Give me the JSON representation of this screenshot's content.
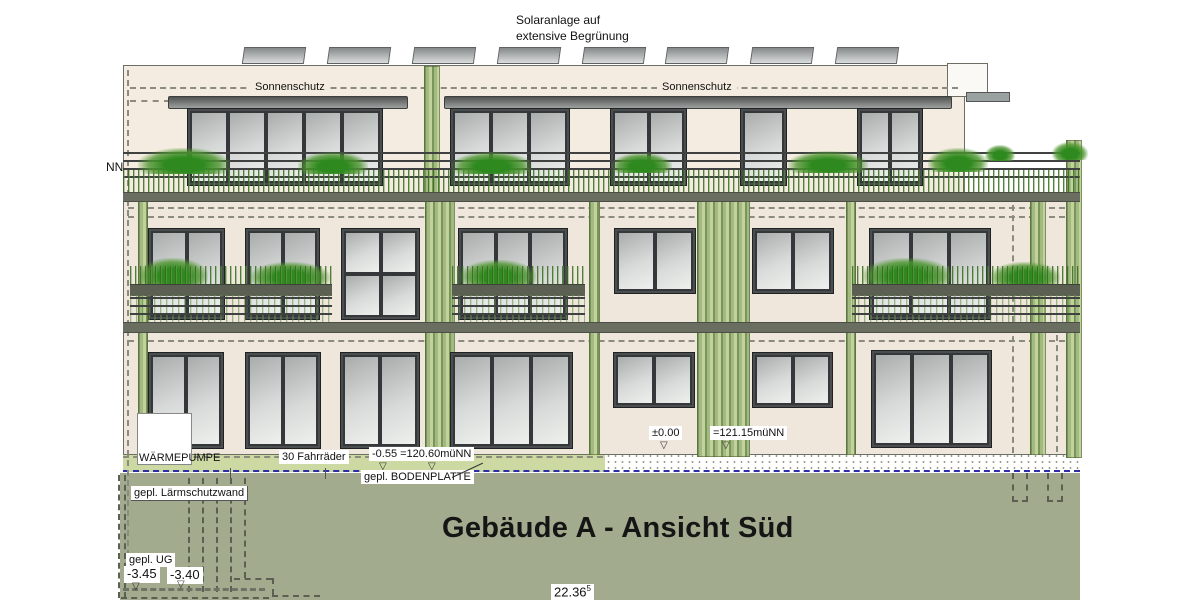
{
  "drawing": {
    "title": "Gebäude A - Ansicht Süd",
    "roof_note_line1": "Solaranlage auf",
    "roof_note_line2": "extensive Begrünung",
    "sonnenschutz_left": "Sonnenschutz",
    "sonnenschutz_right": "Sonnenschutz",
    "left_level_partial": "NN",
    "heat_pump": "WÄRMEPUMPE",
    "bikes": "30 Fahrräder",
    "level_ground_floor": "-0.55 =120.60müNN",
    "base_plate": "gepl. BODENPLATTE",
    "level_zero": "±0.00",
    "level_zero_value": "=121.15müNN",
    "noise_wall": "gepl. Lärmschutzwand",
    "basement": "gepl. UG",
    "level_basement_a": "-3.45",
    "level_basement_b": "-3.40",
    "width_dim": "22.36",
    "width_dim_sup": "5",
    "marker_glyph": "▽",
    "colors": {
      "ground": "#a3ab8e",
      "ground_band": "#ccd9a2",
      "wall": "#efe6dc",
      "penthouse_wall": "#f5ece1",
      "vegetation_green": "#6f9a4d",
      "foundation_line_blue": "#2d2da8",
      "frame_dark": "#35383a"
    }
  }
}
